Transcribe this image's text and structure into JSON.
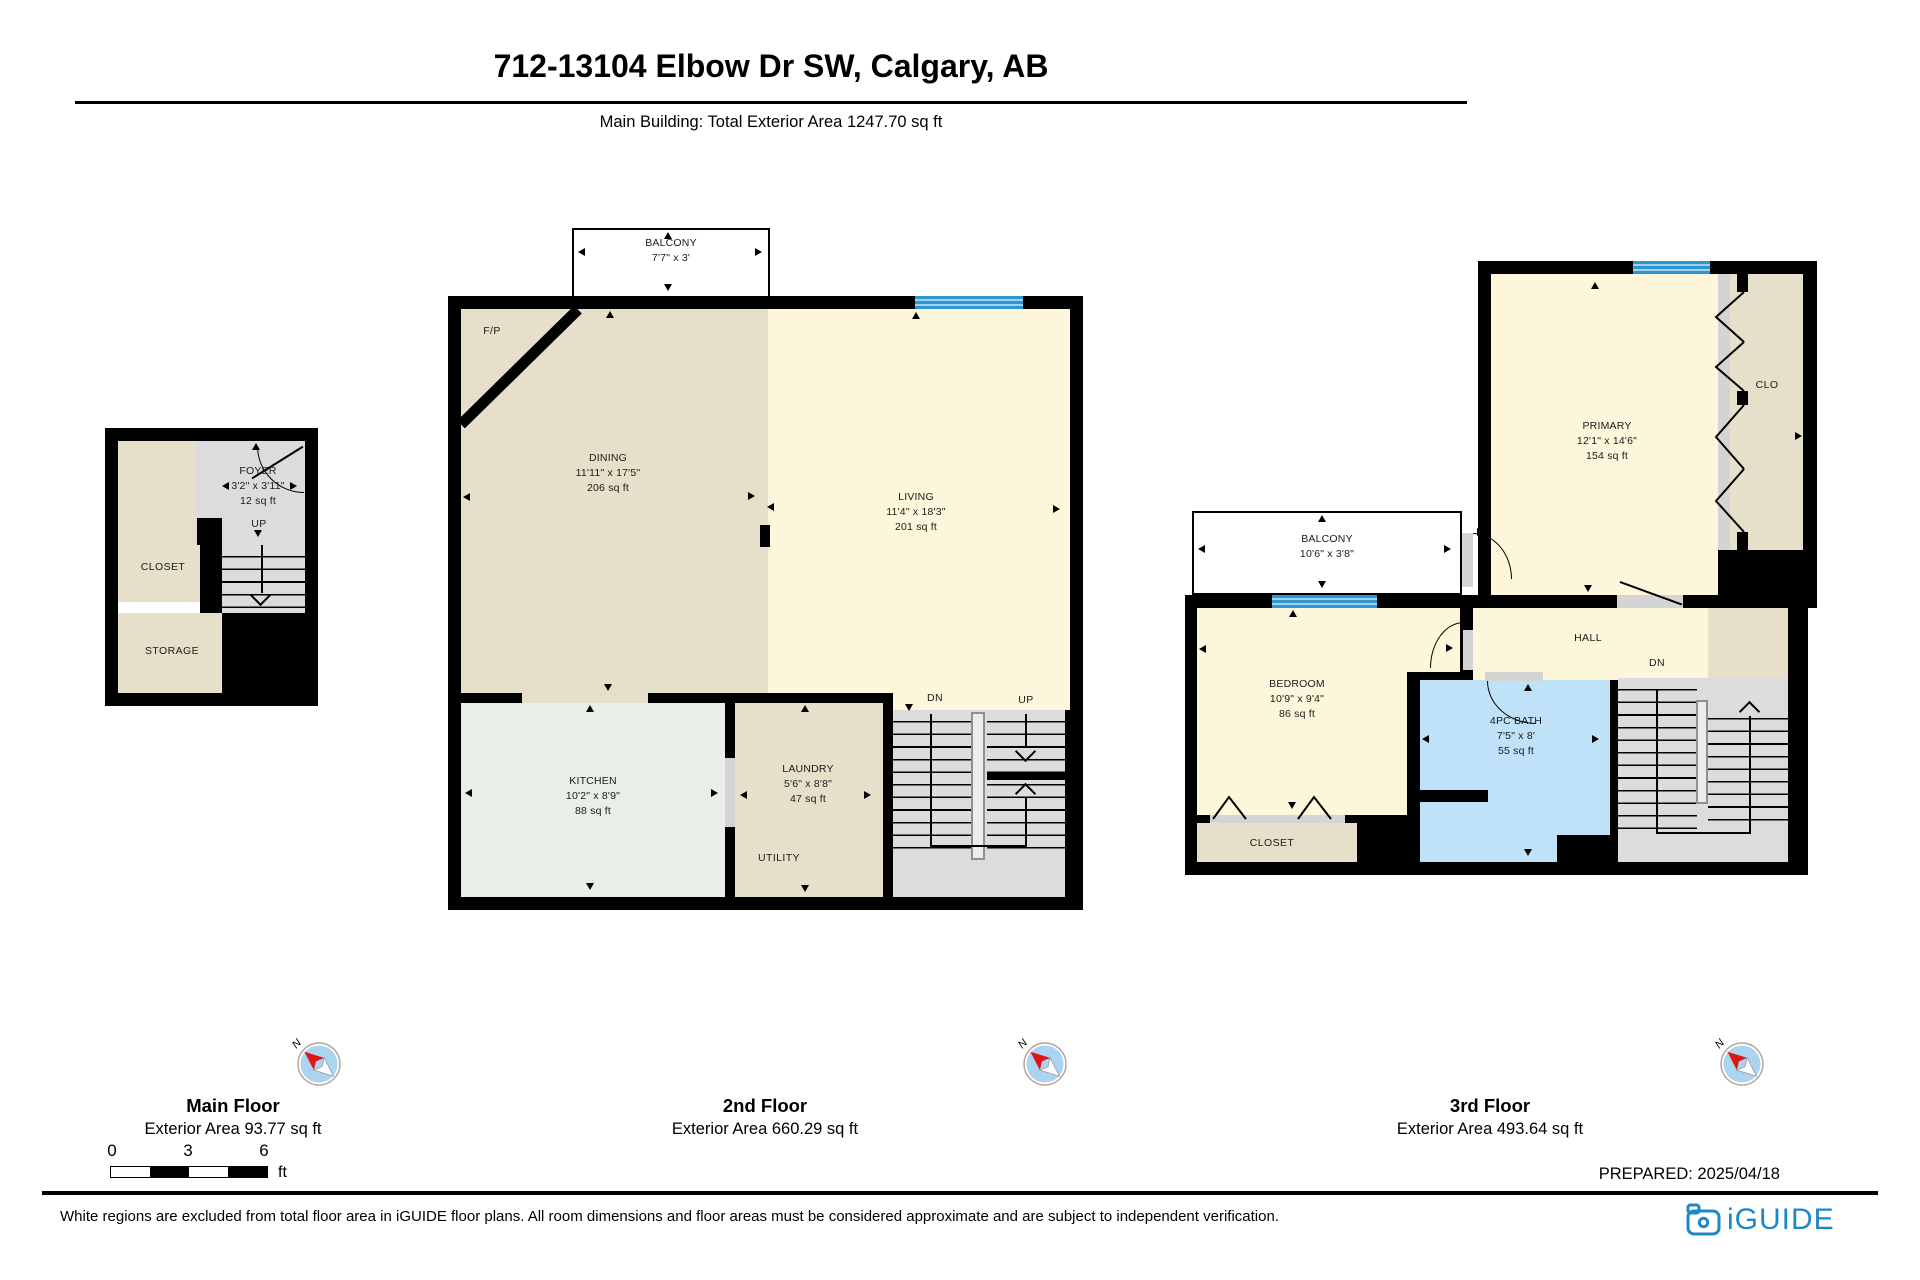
{
  "header": {
    "title": "712-13104 Elbow Dr SW, Calgary, AB",
    "subtitle": "Main Building: Total Exterior Area 1247.70 sq ft"
  },
  "floors": {
    "main": {
      "name": "Main Floor",
      "area_label": "Exterior Area 93.77 sq ft",
      "foyer_name": "FOYER",
      "foyer_dims": "3'2\" x 3'11\"",
      "foyer_area": "12 sq ft",
      "up": "UP",
      "closet": "CLOSET",
      "storage": "STORAGE"
    },
    "second": {
      "name": "2nd Floor",
      "area_label": "Exterior Area 660.29 sq ft",
      "balcony_name": "BALCONY",
      "balcony_dims": "7'7\" x 3'",
      "fp": "F/P",
      "dining_name": "DINING",
      "dining_dims": "11'11\" x 17'5\"",
      "dining_area": "206 sq ft",
      "living_name": "LIVING",
      "living_dims": "11'4\" x 18'3\"",
      "living_area": "201 sq ft",
      "kitchen_name": "KITCHEN",
      "kitchen_dims": "10'2\" x 8'9\"",
      "kitchen_area": "88 sq ft",
      "laundry_name": "LAUNDRY",
      "laundry_dims": "5'6\" x 8'8\"",
      "laundry_area": "47 sq ft",
      "utility": "UTILITY",
      "dn": "DN",
      "up": "UP"
    },
    "third": {
      "name": "3rd Floor",
      "area_label": "Exterior Area 493.64 sq ft",
      "primary_name": "PRIMARY",
      "primary_dims": "12'1\" x 14'6\"",
      "primary_area": "154 sq ft",
      "clo": "CLO",
      "balcony_name": "BALCONY",
      "balcony_dims": "10'6\" x 3'8\"",
      "bedroom_name": "BEDROOM",
      "bedroom_dims": "10'9\" x 9'4\"",
      "bedroom_area": "86 sq ft",
      "hall": "HALL",
      "dn": "DN",
      "bath_name": "4PC BATH",
      "bath_dims": "7'5\" x 8'",
      "bath_area": "55 sq ft",
      "closet": "CLOSET"
    }
  },
  "scale": {
    "t0": "0",
    "t3": "3",
    "t6": "6",
    "unit": "ft"
  },
  "compass_n": "N",
  "prepared": "PREPARED: 2025/04/18",
  "footer": {
    "disclaimer": "White regions are excluded from total floor area in iGUIDE floor plans. All room dimensions and floor areas must be considered approximate and are subject to independent verification.",
    "logo": "iGUIDE"
  },
  "colors": {
    "wall": "#000000",
    "tan": "#e6dfca",
    "cream": "#fdf6da",
    "mint": "#e7efe6",
    "bath_blue": "#bfe2f8",
    "stair_gray": "#dcdcdc",
    "window_blue": "#2e96d0",
    "logo_blue": "#1e87c5",
    "compass_blue": "#aad4f0",
    "compass_red": "#e01414"
  }
}
